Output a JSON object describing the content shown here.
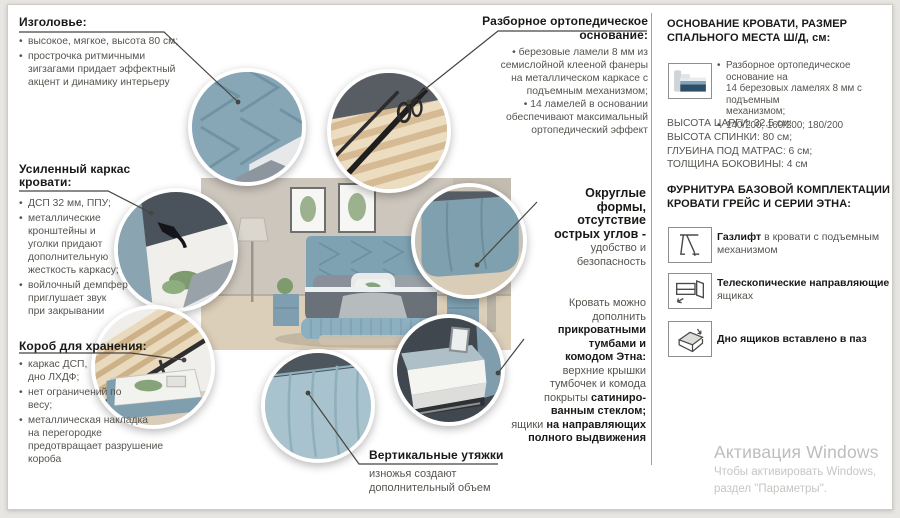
{
  "colors": {
    "accent_blue": "#84a7b8",
    "text_gray": "#57544f",
    "heading": "#1a1917",
    "watermark": "#bdbdbc"
  },
  "callouts": {
    "headboard": {
      "title": "Изголовье:",
      "bullets": [
        "высокое, мягкое, высота 80 см;",
        "прострочка ритмичными\nзигзагами придает эффектный\nакцент и динамику интерьеру"
      ]
    },
    "frame": {
      "title": "Усиленный каркас кровати:",
      "bullets": [
        "ДСП 32 мм, ППУ;",
        "металлические\nкронштейны и\nуголки придают\nдополнительную\nжесткость каркасу;",
        "войлочный демпфер\nприглушает звук\nпри закрывании"
      ]
    },
    "storage": {
      "title": "Короб для хранения:",
      "bullets": [
        "каркас ДСП,\nдно ЛХДФ;",
        "нет ограничений по\nвесу;",
        "металлическая накладка\nна перегородке\nпредотвращает разрушение\nкороба"
      ]
    },
    "base": {
      "title": "Разборное ортопедическое основание:",
      "bullets": [
        "березовые ламели 8 мм из\nсемислойной клееной фанеры\nна металлическом каркасе с\nподъемным механизмом;",
        "14 ламелей в основании\nобеспечивают максимальный\nортопедический эффект"
      ]
    },
    "rounded": {
      "bold": "Округлые\nформы,\nотсутствие\nострых углов -",
      "normal": "удобство и\nбезопасность"
    },
    "nightstands": {
      "lines": [
        {
          "pre": "Кровать можно"
        },
        {
          "pre": "дополнить"
        },
        {
          "bold": "прикроватными"
        },
        {
          "bold": "тумбами и"
        },
        {
          "bold": "комодом Этна:"
        },
        {
          "pre": "верхние крышки"
        },
        {
          "pre": "тумбочек и комода"
        },
        {
          "pre": "покрыты ",
          "bold": "сатиниро-"
        },
        {
          "bold": "ванным стеклом;"
        },
        {
          "pre": "ящики ",
          "bold": "на направляющих"
        },
        {
          "bold": "полного выдвижения"
        }
      ]
    },
    "ties": {
      "title": "Вертикальные утяжки",
      "text": "изножья создают\nдополнительный объем"
    }
  },
  "right_panel": {
    "size_section": {
      "title": "ОСНОВАНИЕ КРОВАТИ, РАЗМЕР СПАЛЬНОГО МЕСТА Ш/Д, см:",
      "icon": "bed-with-lift-icon",
      "bullets": [
        "Разборное ортопедическое основание на\n14 березовых ламелях 8 мм с подъемным\nмеханизмом;",
        "140/200; 160/200; 180/200"
      ],
      "dimensions": [
        "ВЫСОТА ЦАРГИ: 32,5 см;",
        "ВЫСОТА СПИНКИ: 80 см;",
        "ГЛУБИНА ПОД МАТРАС: 6 см;",
        "ТОЛЩИНА БОКОВИНЫ: 4 см"
      ]
    },
    "hardware_section": {
      "title": "ФУРНИТУРА БАЗОВОЙ КОМПЛЕКТАЦИИ КРОВАТИ ГРЕЙС И СЕРИИ ЭТНА:",
      "items": [
        {
          "icon": "gas-lift-icon",
          "bold": "Газлифт",
          "rest": " в кровати с подъемным механизмом"
        },
        {
          "icon": "telescopic-rails-icon",
          "bold": "Телескопические направляющие",
          "rest": " в ящиках"
        },
        {
          "icon": "drawer-bottom-icon",
          "bold": "Дно ящиков вставлено в паз",
          "rest": ""
        }
      ]
    }
  },
  "watermark": {
    "title": "Активация Windows",
    "line1": "Чтобы активировать Windows,",
    "line2": "раздел \"Параметры\"."
  }
}
